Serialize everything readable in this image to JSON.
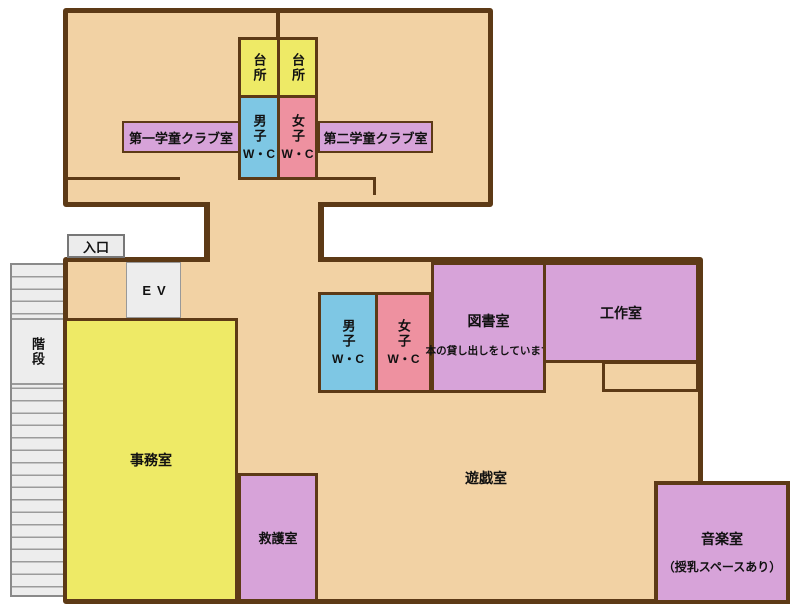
{
  "colors": {
    "floor": "#f2d2a4",
    "wall": "#5d3a16",
    "yellow": "#eeea66",
    "blue": "#7ec7e4",
    "pink": "#ee91a0",
    "purple": "#d7a3d9",
    "gray": "#ededed",
    "ink": "#111111"
  },
  "upper_floor": {
    "kitchen_left": "台所",
    "kitchen_right": "台所",
    "boys_wc": "男子",
    "boys_wc_sub": "W・C",
    "girls_wc": "女子",
    "girls_wc_sub": "W・C",
    "club_room_1": "第一学童クラブ室",
    "club_room_2": "第二学童クラブ室"
  },
  "main_floor": {
    "entrance": "入口",
    "elevator": "EV",
    "stairs": "階段",
    "office": "事務室",
    "first_aid": "救護室",
    "boys_wc": "男子",
    "boys_wc_sub": "W・C",
    "girls_wc": "女子",
    "girls_wc_sub": "W・C",
    "library": "図書室",
    "library_note": "本の貸し出しをしています",
    "craft_room": "工作室",
    "play_room": "遊戯室",
    "music_room": "音楽室",
    "music_room_note": "（授乳スペースあり）"
  }
}
